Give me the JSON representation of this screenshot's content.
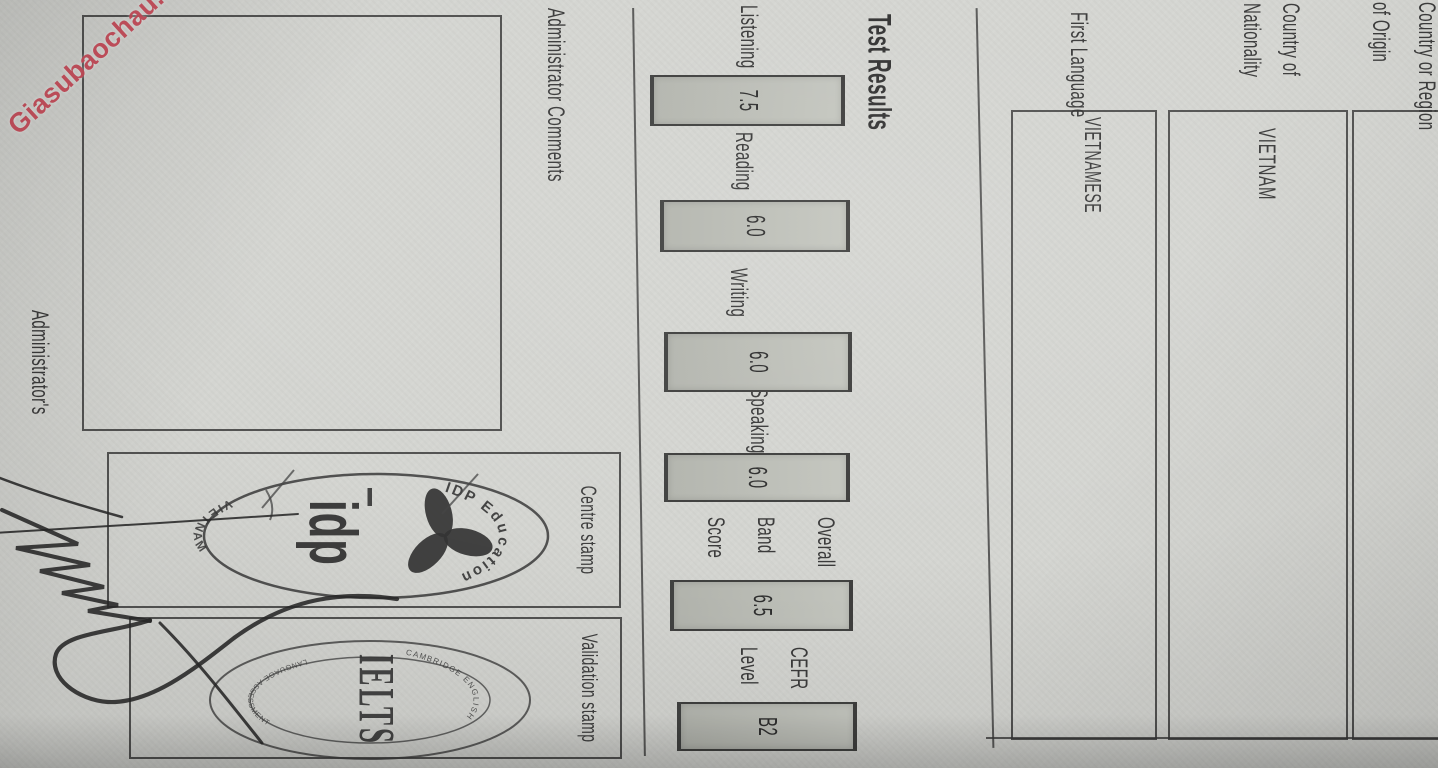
{
  "watermark": {
    "text": "Giasubaochau.net",
    "color": "#c94b59"
  },
  "fields": {
    "origin": {
      "label_line1": "Country or Region",
      "label_line2": "of Origin",
      "value": ""
    },
    "nationality": {
      "label_line1": "Country of",
      "label_line2": "Nationality",
      "value": "VIETNAM"
    },
    "first_language": {
      "label": "First Language",
      "value": "VIETNAMESE"
    }
  },
  "test_results": {
    "title": "Test Results",
    "scores": [
      {
        "label": "Listening",
        "value": "7.5"
      },
      {
        "label": "Reading",
        "value": "6.0"
      },
      {
        "label": "Writing",
        "value": "6.0"
      },
      {
        "label": "Speaking",
        "value": "6.0"
      },
      {
        "label": "Overall Band Score",
        "label_lines": [
          "Overall",
          "Band",
          "Score"
        ],
        "value": "6.5"
      },
      {
        "label": "CEFR Level",
        "label_lines": [
          "CEFR",
          "Level"
        ],
        "value": "B2"
      }
    ]
  },
  "admin": {
    "comments_label": "Administrator Comments",
    "signature_label": "Administrator's",
    "centre_stamp_label": "Centre stamp",
    "validation_stamp_label": "Validation stamp"
  },
  "stamps": {
    "centre": {
      "arc_top": "IDP Education",
      "wordmark": "idp",
      "arc_bottom": "VIETNAM"
    },
    "validation": {
      "center_text": "IELTS",
      "arc_top": "CAMBRIDGE ENGLISH",
      "arc_bottom": "LANGUAGE ASSESSMENT"
    }
  }
}
